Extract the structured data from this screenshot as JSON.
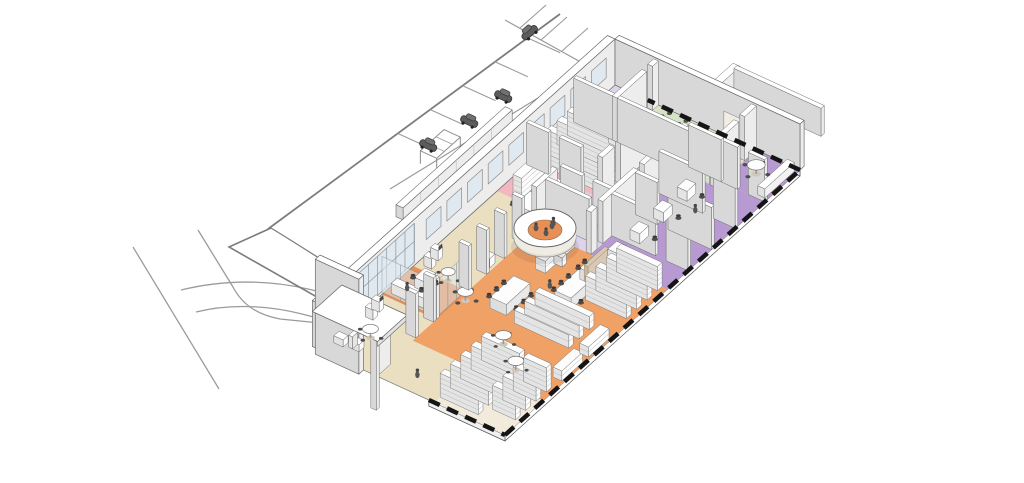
{
  "scene": {
    "description": "Axonometric cutaway rendering of a single-storey public library: colored floor zones, book stacks, reading tables, circular information desk, meeting room with chair rows, study offices, site roads and a parking lot with cars.",
    "visible_text": "none"
  },
  "colors": {
    "bg": "#ffffff",
    "base": "#ebdfc2",
    "frontPale": "#f2ebdc",
    "orange": "#f0a166",
    "orangeDeep": "#e78f55",
    "pink": "#f2b7bf",
    "green": "#d5e3c8",
    "purple": "#b79ad2",
    "purpleLight": "#cbb6e0",
    "lavender": "#ddd3ed",
    "paleFloor": "#f2ede3",
    "wallTop": "#ffffff",
    "wallFace": "#ededed",
    "wallSide": "#d8d8d8",
    "line": "#6a6a6a",
    "glass": "#dfe9f0",
    "glassFrame": "#8d979e",
    "shelfFace": "#fdfdfd",
    "shelfSide": "#e4e4e4",
    "shelfLine": "#b5b5b5",
    "table": "#fdfdfd",
    "tableEdge": "#8f8f8f",
    "chair": "#4c4c4c",
    "chairGreen": "#4e5349",
    "chairGreenBack": "#3f443b",
    "road": "#9b9b9b",
    "roadDark": "#7d7d7d",
    "shadow": "#d8d8d8",
    "shadowDark": "#c9c9c9",
    "cut": "#151515",
    "carBody": "#5c5c5c",
    "carRoof": "#707070",
    "carWheel": "#222222",
    "person": "#555555",
    "deskPlinth": "#e3dcd0",
    "mediaDivider": "#d9c9b2"
  },
  "zones": [
    {
      "name": "main-collection-hall",
      "color_key": "orange"
    },
    {
      "name": "reading-lounge-and-perimeter",
      "color_key": "base"
    },
    {
      "name": "stacks-alcove",
      "color_key": "pink"
    },
    {
      "name": "meeting-room",
      "color_key": "green"
    },
    {
      "name": "study-offices-corridor",
      "color_key": "purple"
    },
    {
      "name": "small-study-rooms",
      "color_key": "lavender"
    },
    {
      "name": "conference-room",
      "color_key": "purple"
    },
    {
      "name": "glass-computer-room",
      "color_key": "orangeDeep"
    }
  ],
  "site": {
    "parking_stall_stripes": 9,
    "parked_cars": 4,
    "road_lines": 4,
    "pergola": 1
  },
  "inventory": {
    "tall_stack_rows_front": 13,
    "tall_stack_rows_pink_zone": 5,
    "low_browsing_shelves": 5,
    "long_tables": 5,
    "round_tables": 7,
    "meeting_room_chairs": 30,
    "office_desks": 6,
    "circular_info_desk": 1,
    "benches": 3,
    "people": 5
  }
}
